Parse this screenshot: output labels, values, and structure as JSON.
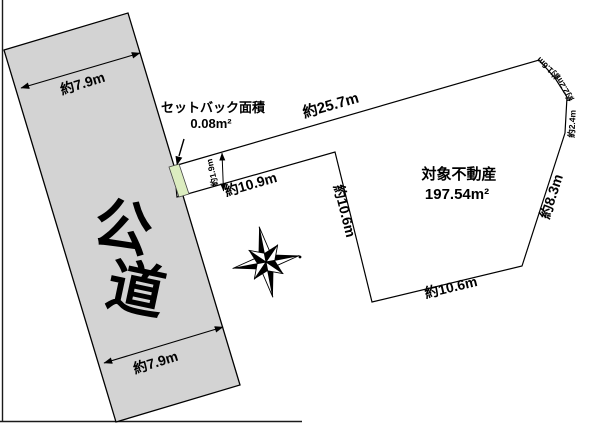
{
  "figure": {
    "title_hint": "土地区画図",
    "background": "#ffffff",
    "line_color": "#000000",
    "road": {
      "label_char1": "公",
      "label_char2": "道",
      "fill": "#d3d3d3",
      "width_top": "約7.9m",
      "width_bottom": "約7.9m"
    },
    "parcel": {
      "name": "対象不動産",
      "area": "197.54m²",
      "fill": "#ffffff",
      "edges": {
        "top": "約25.7m",
        "strip_bottom": "約10.9m",
        "strip_width": "約1.9m",
        "left": "約10.6m",
        "bottom": "約10.6m",
        "right": "約8.3m",
        "corner_seg_1": "約1.6m",
        "corner_seg_2": "約2.2m",
        "corner_seg_3": "約2.4m"
      }
    },
    "setback": {
      "label_line1": "セットバック面積",
      "label_line2": "0.08m²",
      "fill": "#dcedc0"
    }
  }
}
